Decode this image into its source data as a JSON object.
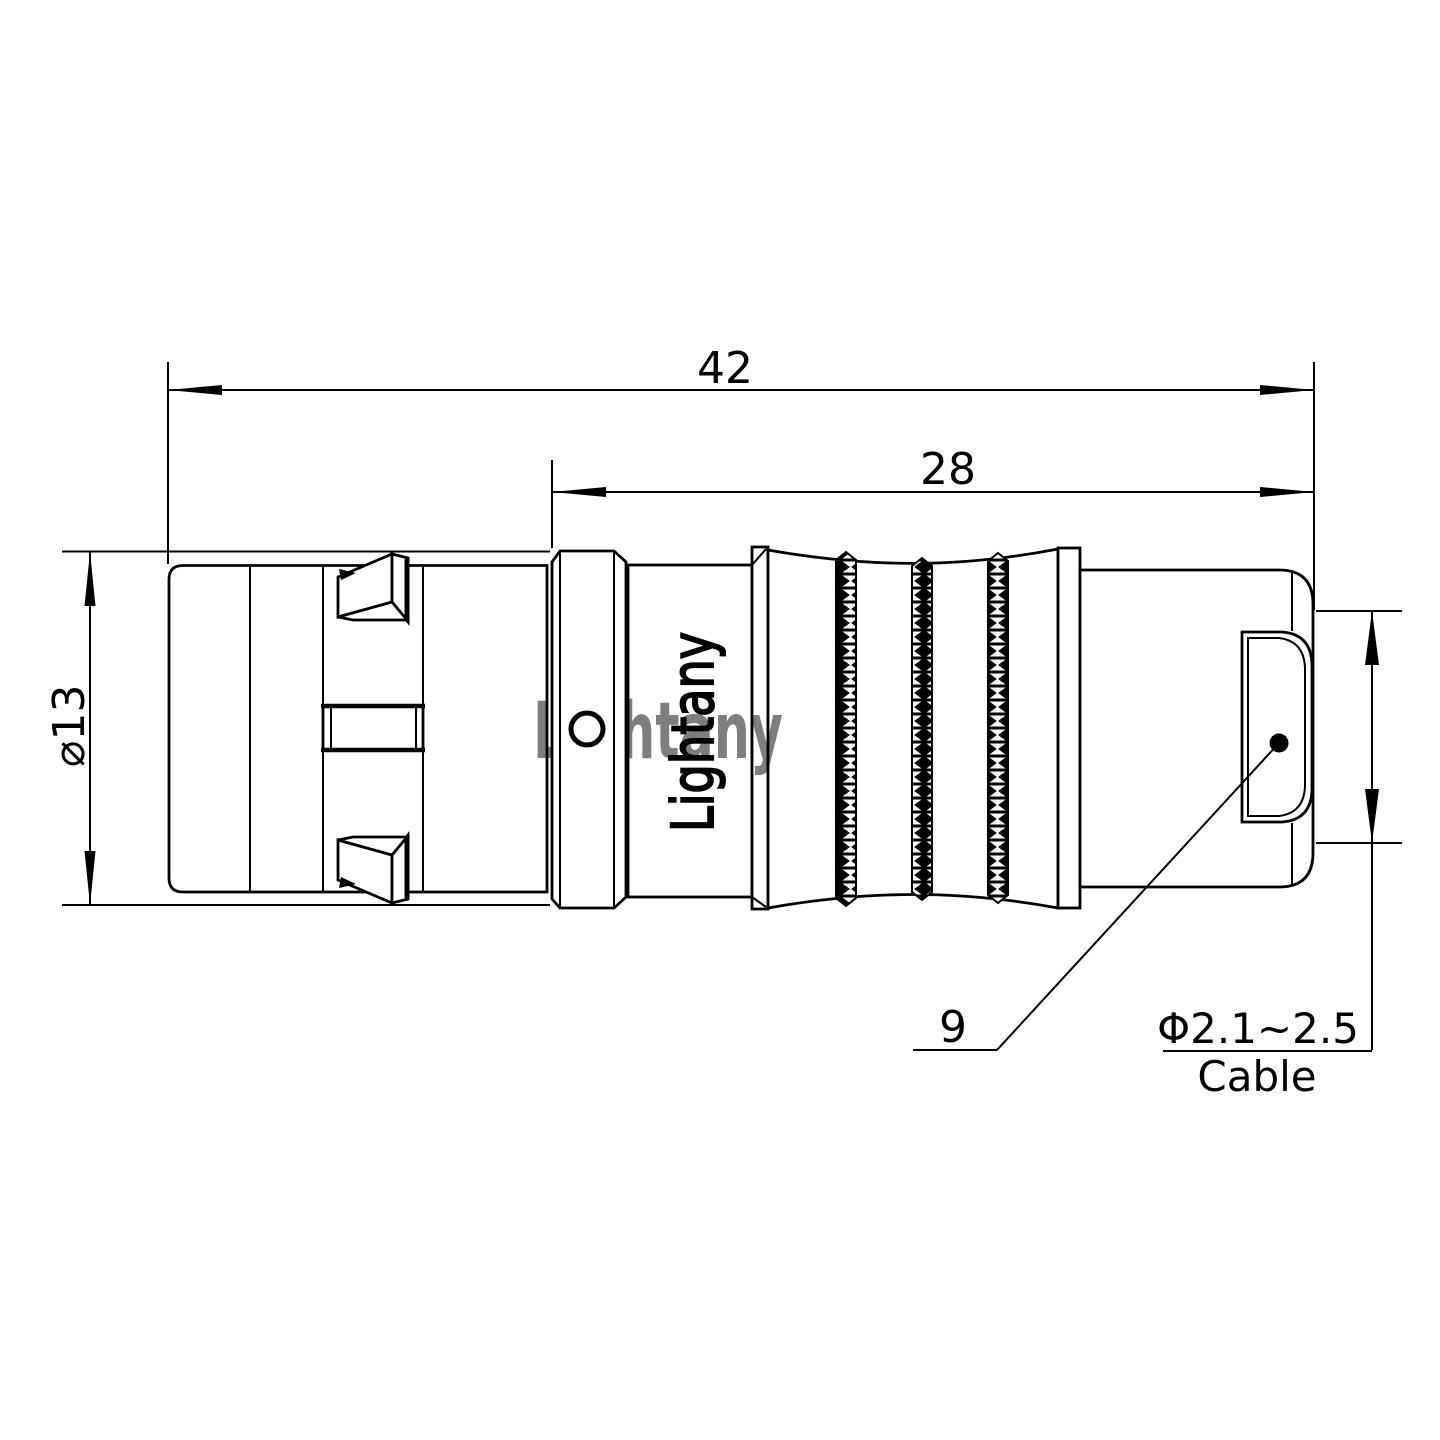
{
  "page": {
    "background": "#ffffff",
    "kind": "connector technical dimension drawing"
  },
  "drawing": {
    "labels": {
      "overall_length": "42",
      "rear_length": "28",
      "diameter": "⌀13",
      "shell_size": "9",
      "cable_range": "Φ2.1~2.5",
      "cable_word": "Cable"
    },
    "engraving": "Lightany",
    "watermark": "Lightany",
    "colors": {
      "line": "#000000",
      "paper": "#ffffff",
      "watermark": "#e89a9e"
    }
  }
}
